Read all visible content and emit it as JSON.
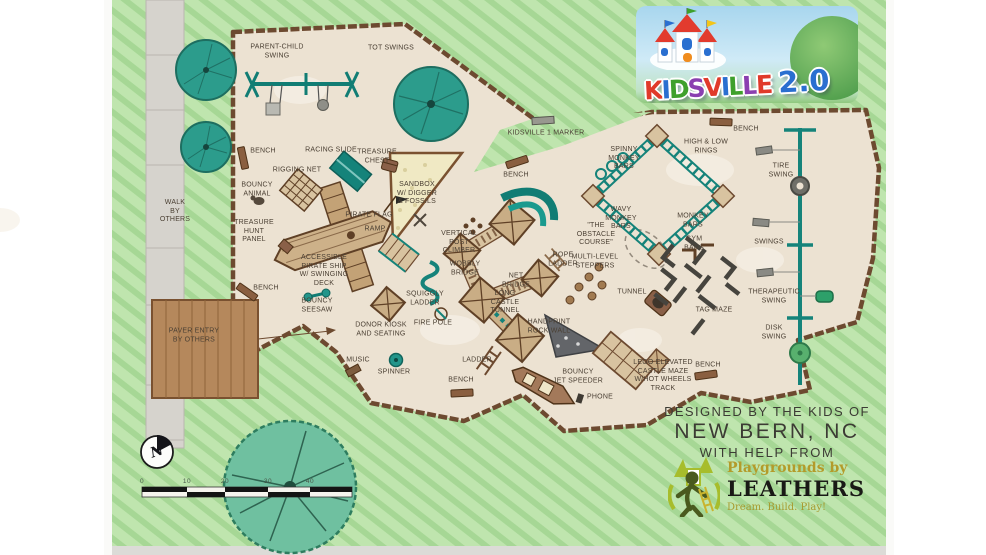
{
  "title": "Kidsville 2.0 playground site plan",
  "logo": {
    "letters": [
      "K",
      "I",
      "D",
      "S",
      "V",
      "I",
      "L",
      "L",
      "E"
    ],
    "suffix": "2.0"
  },
  "credits": {
    "line1": "DESIGNED BY THE KIDS OF",
    "line2": "NEW BERN, NC",
    "line3": "WITH HELP FROM"
  },
  "leathers": {
    "brand_top": "Playgrounds by",
    "brand": "LEATHERS",
    "tagline": "Dream. Build. Play!"
  },
  "compass": {
    "label": "N"
  },
  "scale": {
    "ticks": [
      "0",
      "10",
      "20",
      "30",
      "40"
    ]
  },
  "palette": {
    "lawn_light": "#bfe5ae",
    "lawn_stripe": "#a6d795",
    "surface_tan": "#ece2d2",
    "timber_brown": "#6d4a30",
    "equipment_teal": "#15837a",
    "structure_brown": "#8a6048",
    "deck_tan": "#d8c3a0",
    "walk_gray": "#d6d3cd",
    "paver_brown": "#b5885c",
    "sand_cream": "#f0e9c4",
    "tree_teal": "#2c9c8c",
    "logo_sky": "#a8d6ee",
    "leathers_olive": "#b39b2a",
    "ink": "#4b4034"
  },
  "labels": [
    {
      "text": "PARENT-CHILD\nSWING"
    },
    {
      "text": "TOT SWINGS"
    },
    {
      "text": "BENCH"
    },
    {
      "text": "RACING SLIDE"
    },
    {
      "text": "TREASURE\nCHEST"
    },
    {
      "text": "RIGGING NET"
    },
    {
      "text": "BOUNCY\nANIMAL"
    },
    {
      "text": "WALK\nBY\nOTHERS"
    },
    {
      "text": "TREASURE\nHUNT\nPANEL"
    },
    {
      "text": "PIRATE FLAG"
    },
    {
      "text": "RAMP"
    },
    {
      "text": "ACCESSIBLE\nPIRATE SHIP\nW/ SWINGING\nDECK"
    },
    {
      "text": "BENCH"
    },
    {
      "text": "BOUNCY\nSEESAW"
    },
    {
      "text": "PAVER ENTRY\nBY OTHERS"
    },
    {
      "text": "SANDBOX\nW/ DIGGER\n& FOSSILS"
    },
    {
      "text": "BENCH"
    },
    {
      "text": "KIDSVILLE 1 MARKER"
    },
    {
      "text": "VERTICAL\nPOST\nCLIMBER"
    },
    {
      "text": "WOBBLY\nBRIDGE"
    },
    {
      "text": "SQUIGGLY\nLADDER"
    },
    {
      "text": "DONOR KIOSK\nAND SEATING"
    },
    {
      "text": "FIRE POLE"
    },
    {
      "text": "NET\nBRIDGE"
    },
    {
      "text": "LONG\nCASTLE\nTUNNEL"
    },
    {
      "text": "HANDPRINT\nROCK WALL"
    },
    {
      "text": "ROPE\nLADDER"
    },
    {
      "text": "MULTI-LEVEL\nSTEPPERS"
    },
    {
      "text": "\"THE\nOBSTACLE\nCOURSE\""
    },
    {
      "text": "TUNNEL"
    },
    {
      "text": "LADDER"
    },
    {
      "text": "MUSIC"
    },
    {
      "text": "SPINNER"
    },
    {
      "text": "BENCH"
    },
    {
      "text": "BOUNCY\nJET SPEEDER"
    },
    {
      "text": "PHONE"
    },
    {
      "text": "LEGO ELEVATED\nCASTLE MAZE\nW/HOT WHEELS\nTRACK"
    },
    {
      "text": "BENCH"
    },
    {
      "text": "SPINNY\nMONKEY\nBARS"
    },
    {
      "text": "HIGH & LOW\nRINGS"
    },
    {
      "text": "BENCH"
    },
    {
      "text": "TIRE\nSWING"
    },
    {
      "text": "WAVY\nMONKEY\nBARS"
    },
    {
      "text": "MONKEY\nBARS"
    },
    {
      "text": "GYM\nBARS"
    },
    {
      "text": "SWINGS"
    },
    {
      "text": "TAG MAZE"
    },
    {
      "text": "THERAPEUTIC\nSWING"
    },
    {
      "text": "DISK\nSWING"
    }
  ]
}
